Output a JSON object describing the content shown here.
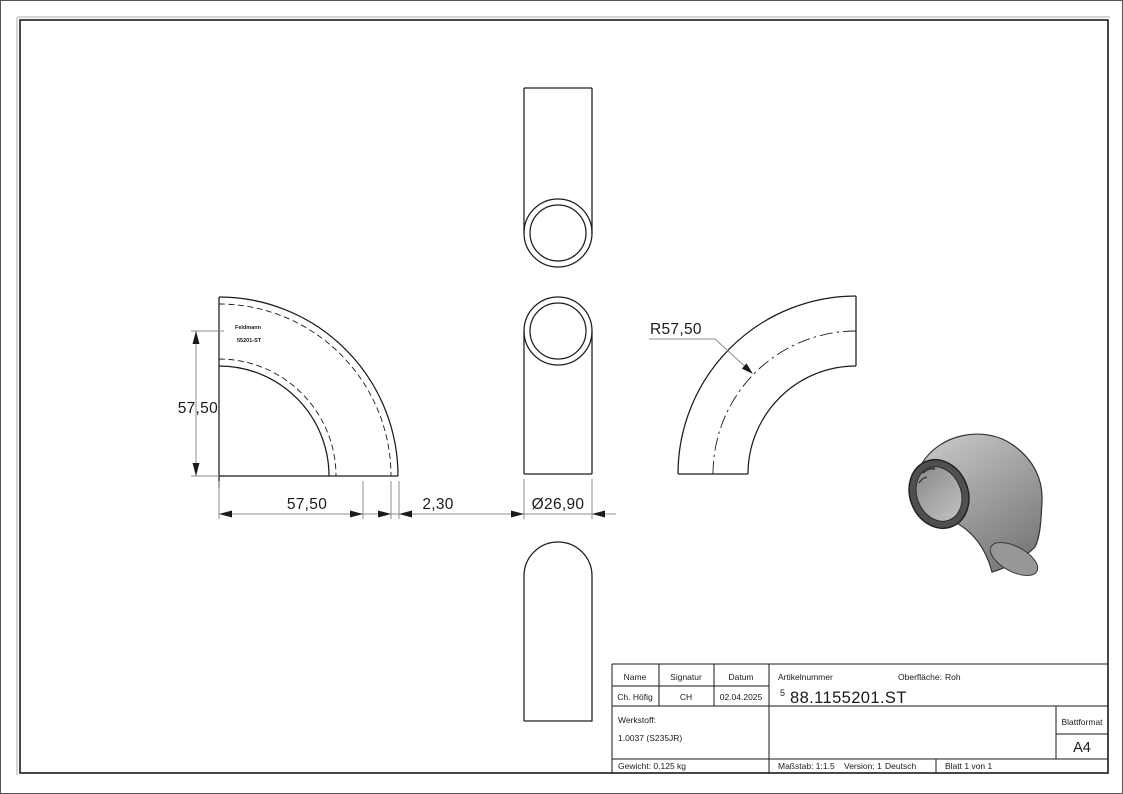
{
  "drawing": {
    "dimensions": {
      "height": "57,50",
      "bend_radius_horizontal": "57,50",
      "wall_thickness": "2,30",
      "diameter": "Ø26,90",
      "bend_radius": "R57,50"
    },
    "stamp": {
      "line1": "Feldmann",
      "line2": "55201-ST"
    }
  },
  "title_block": {
    "name_label": "Name",
    "signature_label": "Signatur",
    "date_label": "Datum",
    "name_value": "Ch. Höfig",
    "signature_value": "CH",
    "date_value": "02.04.2025",
    "article_label": "Artikelnummer",
    "article_prefix": "5",
    "article_number": "88.1155201.ST",
    "surface_label": "Oberfläche:",
    "surface_value": "Roh",
    "material_label": "Werkstoff:",
    "material_value": "1.0037 (S235JR)",
    "weight": "Gewicht: 0.125 kg",
    "scale": "Maßstab: 1:1.5",
    "version": "Version: 1",
    "language": "Deutsch",
    "sheet": "Blatt 1 von 1",
    "sheet_format_label": "Blattformat",
    "sheet_format_value": "A4"
  },
  "colors": {
    "line": "#1c1c1c",
    "dimension_line": "#8c8c8c",
    "body_light": "#c9c9c9",
    "body_dark": "#7d7d7d",
    "ring_dark": "#4f4f4f"
  }
}
